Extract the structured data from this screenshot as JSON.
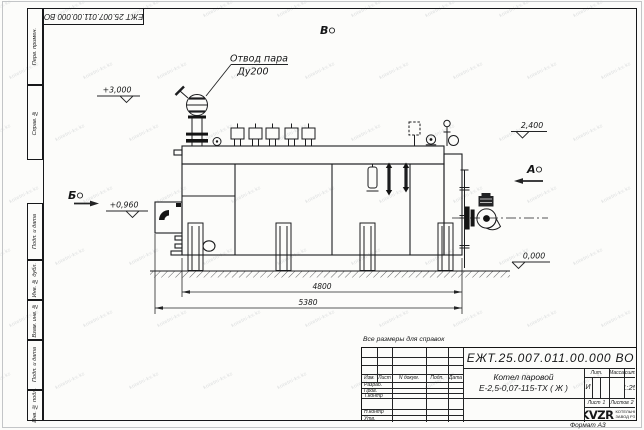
{
  "watermark": {
    "text": "kotelni-kv.kz"
  },
  "sheet": {
    "stamp_top": "ЕЖТ 25.007.011.00.000  ВО",
    "format_note": "Формат А3",
    "margin_labels": {
      "perv_primen": "Перв. примен.",
      "sprav_no": "Справ. №",
      "podp_data_1": "Подп. и дата",
      "inv_dubl": "Инв. № дубл.",
      "vzam_inv": "Взам. инв. №",
      "podp_data_2": "Подп. и дата",
      "inv_podl": "Инв. № подл."
    }
  },
  "drawing": {
    "callout_line1": "Отвод пара",
    "callout_line2": "Ду200",
    "view_top": "В",
    "view_a": "А",
    "view_b": "Б",
    "elev_top": "+3,000",
    "elev_right": "2,400",
    "elev_left": "+0,960",
    "elev_zero": "0,000",
    "dim_inner": "4800",
    "dim_outer": "5380"
  },
  "title_block": {
    "note": "Все размеры для справок",
    "doc_number": "ЕЖТ.25.007.011.00.000  ВО",
    "product_line1": "Котел паровой",
    "product_line2": "Е-2,5-0,07-115-ТХ ( Ж )",
    "columns": {
      "izm": "Изм.",
      "list": "Лист",
      "n_dokum": "N докум.",
      "podp": "Подп.",
      "data": "Дата"
    },
    "rows": {
      "razrab": "Разраб.",
      "prov": "Пров.",
      "t_kontr": "Т.контр",
      "n_kontr": "Н.контр",
      "utv": "Утв."
    },
    "lit_header": "Лит.",
    "lit_value": "И",
    "massa_header": "Масса",
    "masshtab_header": "Масштаб",
    "masshtab_value": "1:25",
    "list_label": "Лист",
    "list_value": "1",
    "listov_label": "Листов",
    "listov_value": "2",
    "logo_text": "KVZR",
    "org_line1": "КОТЕЛЬНЫЙ",
    "org_line2": "ЗАВОД РЭП"
  }
}
